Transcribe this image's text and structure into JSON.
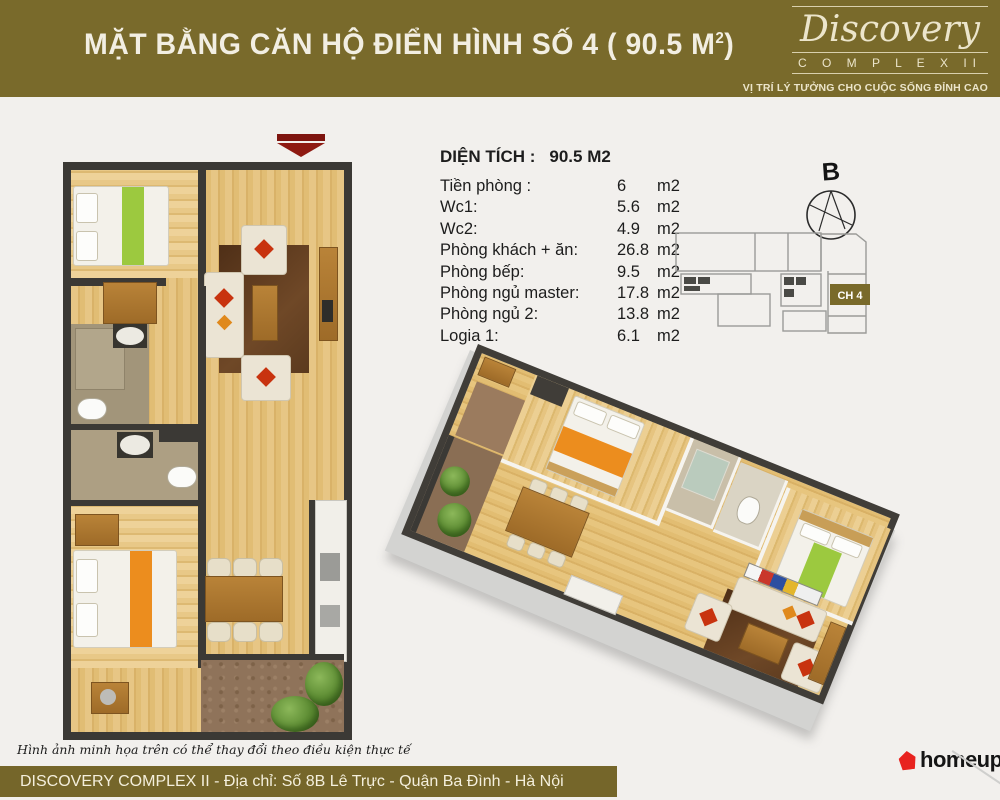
{
  "header": {
    "title_main": "MẶT BẰNG CĂN HỘ ĐIỂN HÌNH SỐ 4 ( 90.5 M",
    "title_sup": "2",
    "title_close": ")",
    "brand": {
      "name": "Discovery",
      "complex_word": "C O M P L E X",
      "complex_numeral": "II",
      "tagline": "VỊ TRÍ LÝ TƯỞNG CHO CUỘC SỐNG ĐỈNH CAO"
    }
  },
  "area_table": {
    "heading_label": "DIỆN TÍCH :",
    "heading_value": "90.5 M2",
    "rows": [
      {
        "label": "Tiền phòng :",
        "value": "6",
        "unit": "m2"
      },
      {
        "label": "Wc1:",
        "value": "5.6",
        "unit": "m2"
      },
      {
        "label": "Wc2:",
        "value": "4.9",
        "unit": "m2"
      },
      {
        "label": "Phòng khách + ăn:",
        "value": "26.8",
        "unit": "m2"
      },
      {
        "label": "Phòng bếp:",
        "value": "9.5",
        "unit": "m2"
      },
      {
        "label": "Phòng ngủ master:",
        "value": "17.8",
        "unit": "m2"
      },
      {
        "label": "Phòng ngủ 2:",
        "value": "13.8",
        "unit": "m2"
      },
      {
        "label": "Logia 1:",
        "value": "6.1",
        "unit": "m2"
      }
    ]
  },
  "site_plan": {
    "compass_label": "B",
    "highlighted_unit": "CH 4"
  },
  "footer": {
    "disclaimer": "Hình ảnh minh họa trên có thể thay đổi theo điều kiện thực tế",
    "address": "DISCOVERY COMPLEX II - Địa chỉ: Số 8B Lê Trực - Quận Ba Đình - Hà Nội",
    "logo_text": "homeup"
  },
  "colors": {
    "olive": "#796a2b",
    "background": "#f2f0ed",
    "wall": "#3b3935",
    "entry_arrow": "#8e1a12",
    "homeup_red": "#e8231f",
    "wood": "#e2bd72",
    "bed_green": "#9cc93f",
    "bed_orange": "#ec8d1e",
    "cushion_red": "#c8330f"
  }
}
